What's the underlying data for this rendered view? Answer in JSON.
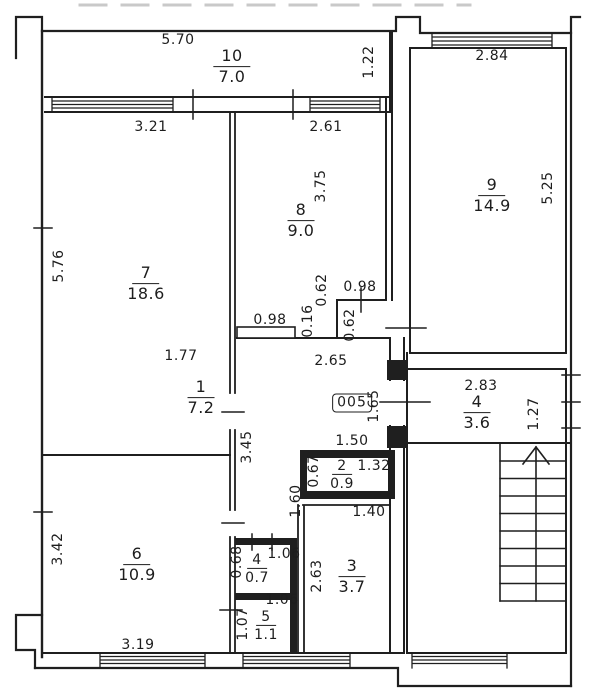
{
  "colors": {
    "ink": "#1d1d1d",
    "paper": "#ffffff"
  },
  "plan": {
    "apartment_number": "005",
    "rooms": {
      "r10": {
        "num": "10",
        "area": "7.0"
      },
      "r9": {
        "num": "9",
        "area": "14.9"
      },
      "r8": {
        "num": "8",
        "area": "9.0"
      },
      "r7": {
        "num": "7",
        "area": "18.6"
      },
      "r1": {
        "num": "1",
        "area": "7.2"
      },
      "r4a": {
        "num": "4",
        "area": "3.6"
      },
      "r2": {
        "num": "2",
        "area": "0.9"
      },
      "r3": {
        "num": "3",
        "area": "3.7"
      },
      "r4b": {
        "num": "4",
        "area": "0.7"
      },
      "r5": {
        "num": "5",
        "area": "1.1"
      },
      "r6": {
        "num": "6",
        "area": "10.9"
      }
    },
    "dims": {
      "w570": "5.70",
      "h122": "1.22",
      "w284": "2.84",
      "h525": "5.25",
      "w321": "3.21",
      "w261": "2.61",
      "h375": "3.75",
      "h576": "5.76",
      "h062a": "0.62",
      "w098a": "0.98",
      "h016": "0.16",
      "w098b": "0.98",
      "h062b": "0.62",
      "w177": "1.77",
      "w265": "2.65",
      "h165": "1.65",
      "w283": "2.83",
      "h127": "1.27",
      "h345": "3.45",
      "w150": "1.50",
      "w132": "1.32",
      "h067": "0.67",
      "h160": "1.60",
      "w140": "1.40",
      "w106a": "1.06",
      "h068": "0.68",
      "h263": "2.63",
      "w106b": "1.06",
      "h107": "1.07",
      "h342": "3.42",
      "w319": "3.19"
    }
  }
}
